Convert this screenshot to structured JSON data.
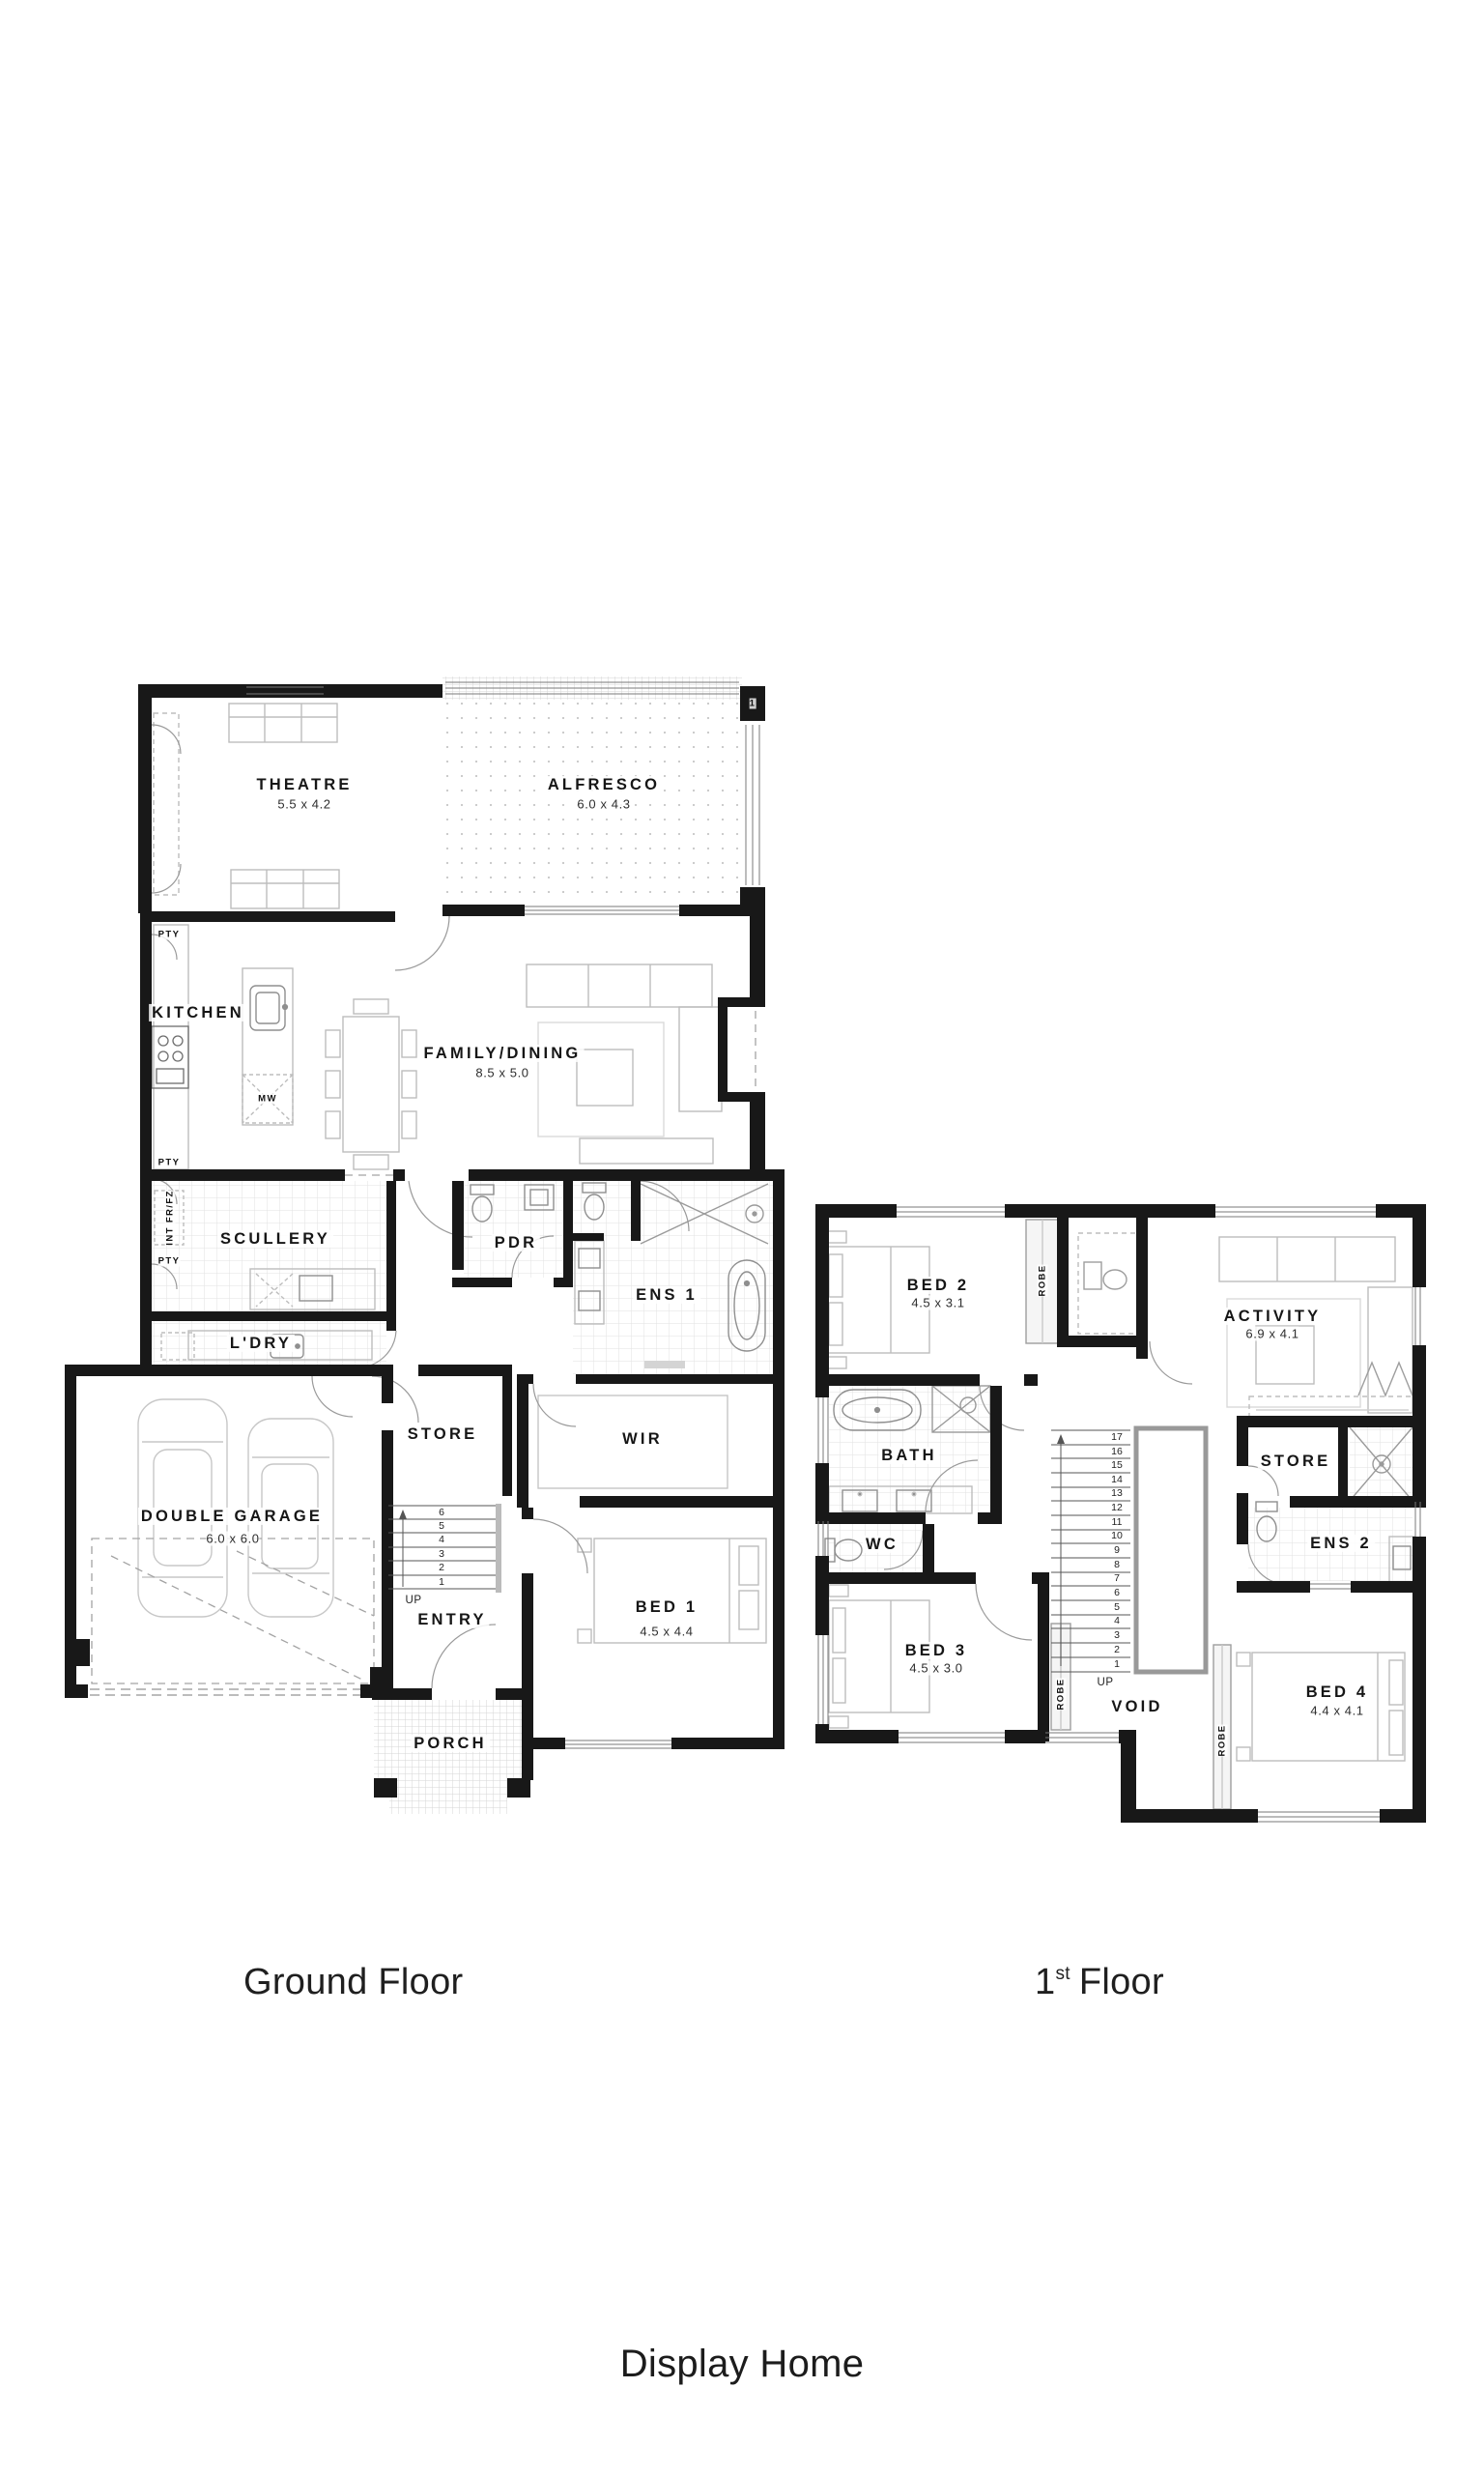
{
  "captions": {
    "ground_floor": "Ground Floor",
    "first_floor_num": "1",
    "first_floor_sup": "st",
    "first_floor_tail": "Floor"
  },
  "footer": {
    "title": "Display Home"
  },
  "ground_floor": {
    "rooms": {
      "theatre": {
        "label": "THEATRE",
        "dims": "5.5 x 4.2"
      },
      "alfresco": {
        "label": "ALFRESCO",
        "dims": "6.0 x 4.3"
      },
      "kitchen": {
        "label": "KITCHEN"
      },
      "family_dining": {
        "label": "FAMILY/DINING",
        "dims": "8.5 x 5.0"
      },
      "scullery": {
        "label": "SCULLERY"
      },
      "pdr": {
        "label": "PDR"
      },
      "ens1": {
        "label": "ENS 1"
      },
      "ldry": {
        "label": "L'DRY"
      },
      "store": {
        "label": "STORE"
      },
      "wir": {
        "label": "WIR"
      },
      "garage": {
        "label": "DOUBLE GARAGE",
        "dims": "6.0 x 6.0"
      },
      "entry": {
        "label": "ENTRY"
      },
      "bed1": {
        "label": "BED 1",
        "dims": "4.5 x 4.4"
      },
      "porch": {
        "label": "PORCH"
      }
    },
    "annotations": {
      "pty": "PTY",
      "int_frfz": "INT FR/FZ",
      "mw": "MW",
      "up": "UP",
      "column_marker": "1"
    },
    "stairs": [
      "6",
      "5",
      "4",
      "3",
      "2",
      "1"
    ]
  },
  "first_floor": {
    "rooms": {
      "bed2": {
        "label": "BED 2",
        "dims": "4.5 x 3.1"
      },
      "activity": {
        "label": "ACTIVITY",
        "dims": "6.9 x 4.1"
      },
      "bath": {
        "label": "BATH"
      },
      "store": {
        "label": "STORE"
      },
      "wc": {
        "label": "WC"
      },
      "ens2": {
        "label": "ENS 2"
      },
      "bed3": {
        "label": "BED 3",
        "dims": "4.5 x 3.0"
      },
      "void": {
        "label": "VOID"
      },
      "bed4": {
        "label": "BED 4",
        "dims": "4.4 x 4.1"
      }
    },
    "annotations": {
      "robe": "ROBE",
      "up": "UP"
    },
    "stairs": [
      "17",
      "16",
      "15",
      "14",
      "13",
      "12",
      "11",
      "10",
      "9",
      "8",
      "7",
      "6",
      "5",
      "4",
      "3",
      "2",
      "1"
    ]
  },
  "colors": {
    "wall": "#181818",
    "furniture": "#bdbdbd",
    "tile": "#e2e2e2"
  }
}
